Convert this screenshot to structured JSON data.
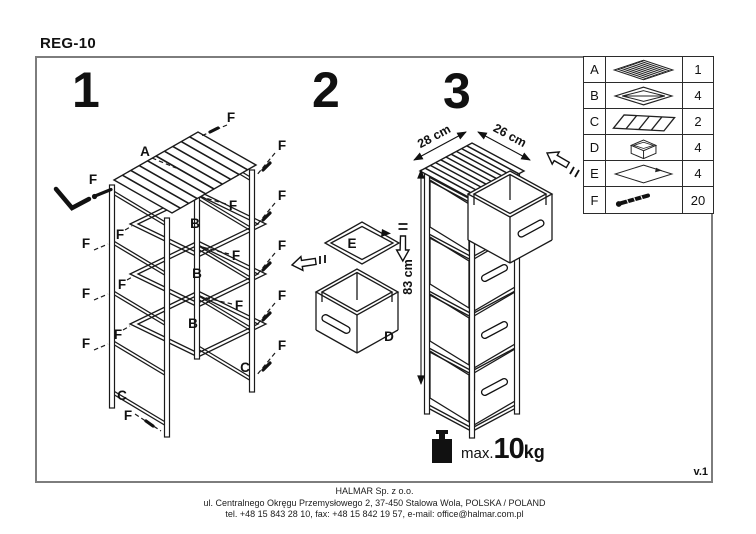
{
  "title": "REG-10",
  "version": "v.1",
  "step1": {
    "number": "1",
    "label_a": "A",
    "label_b": "B",
    "label_c": "C",
    "label_f": "F"
  },
  "step2": {
    "number": "2",
    "label_d": "D",
    "label_e": "E"
  },
  "step3": {
    "number": "3",
    "dim_width": "28 cm",
    "dim_depth": "26 cm",
    "dim_height": "83 cm"
  },
  "parts_table": {
    "rows": [
      {
        "letter": "A",
        "icon": "slatted-top-panel",
        "qty": "1"
      },
      {
        "letter": "B",
        "icon": "shelf-frame",
        "qty": "4"
      },
      {
        "letter": "C",
        "icon": "side-ladder-frame",
        "qty": "2"
      },
      {
        "letter": "D",
        "icon": "drawer-box",
        "qty": "4"
      },
      {
        "letter": "E",
        "icon": "bottom-panel",
        "qty": "4"
      },
      {
        "letter": "F",
        "icon": "screw",
        "qty": "20"
      }
    ]
  },
  "load_limit": {
    "prefix": "max.",
    "value": "10",
    "unit": "kg"
  },
  "footer": {
    "company": "HALMAR Sp. z o.o.",
    "address": "ul. Centralnego Okręgu Przemysłowego 2, 37-450 Stalowa Wola, POLSKA / POLAND",
    "contact": "tel. +48 15 843 28 10, fax: +48 15 842 19 57, e-mail: office@halmar.com.pl"
  }
}
